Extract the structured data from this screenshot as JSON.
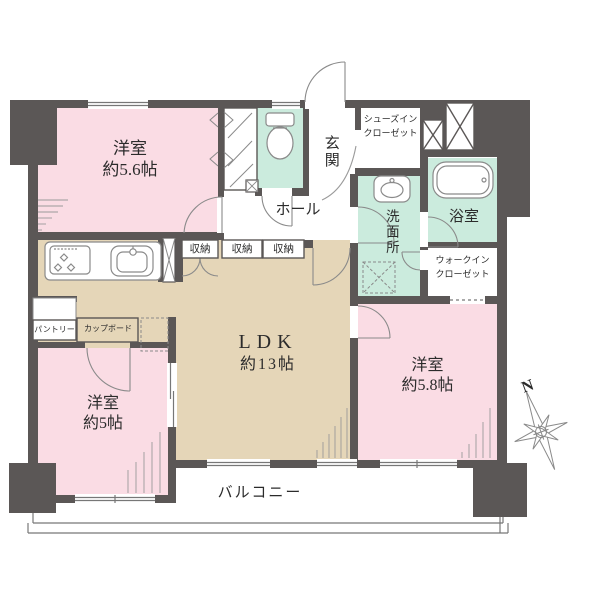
{
  "colors": {
    "wall": "#5B5756",
    "pink": "#FADCE4",
    "beige": "#E5D6B8",
    "mint": "#CBEBDD",
    "line": "#777777",
    "fan": "#9a9a9a",
    "text": "#2b2b2b",
    "white": "#ffffff"
  },
  "rooms": {
    "bedroom56": {
      "name": "洋室",
      "area": "約5.6帖"
    },
    "bedroom58": {
      "name": "洋室",
      "area": "約5.8帖"
    },
    "bedroom5": {
      "name": "洋室",
      "area": "約5帖"
    },
    "ldk": {
      "name": "LDK",
      "area": "約13帖"
    },
    "entrance": "玄関",
    "hall": "ホール",
    "washroom": "洗面所",
    "bathroom": "浴室",
    "shoe_closet": {
      "line1": "シューズイン",
      "line2": "クローゼット"
    },
    "walk_in_closet": {
      "line1": "ウォークイン",
      "line2": "クローゼット"
    },
    "storage": "収納",
    "pantry": "パントリー",
    "cupboard": "カップボード",
    "balcony": "バルコニー"
  },
  "compass": {
    "north": "N"
  }
}
